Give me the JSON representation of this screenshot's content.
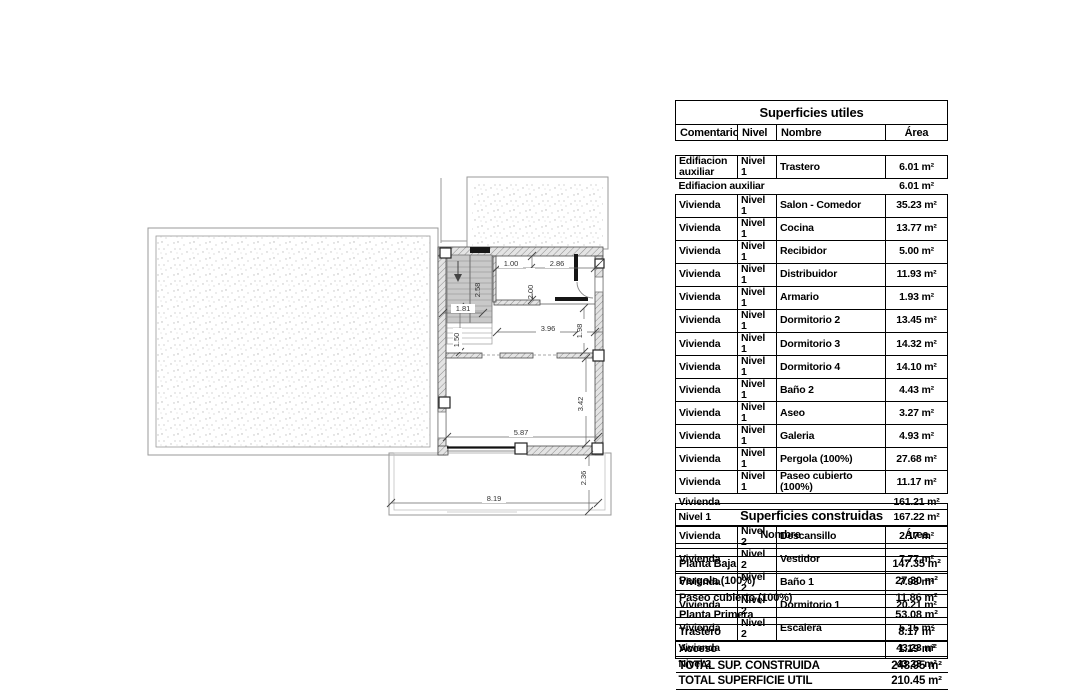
{
  "plan": {
    "dims": {
      "d100": "1.00",
      "d286": "2.86",
      "d200": "2.00",
      "d258": "2.58",
      "d181": "1.81",
      "d150": "1.50",
      "d396": "3.96",
      "d198": "1.98",
      "d342": "3.42",
      "d587": "5.87",
      "d819": "8.19",
      "d236": "2.36"
    }
  },
  "tables": {
    "utiles": {
      "title": "Superficies utiles",
      "columns": [
        "Comentarios",
        "Nivel",
        "Nombre",
        "Área"
      ],
      "rows": [
        {
          "type": "gap"
        },
        {
          "type": "data",
          "comentarios": "Edifiacion auxiliar",
          "nivel": "Nivel 1",
          "nombre": "Trastero",
          "area": "6.01 m²"
        },
        {
          "type": "summary",
          "label": "Edifiacion auxiliar",
          "area": "6.01 m²"
        },
        {
          "type": "data",
          "comentarios": "Vivienda",
          "nivel": "Nivel 1",
          "nombre": "Salon - Comedor",
          "area": "35.23 m²"
        },
        {
          "type": "data",
          "comentarios": "Vivienda",
          "nivel": "Nivel 1",
          "nombre": "Cocina",
          "area": "13.77 m²"
        },
        {
          "type": "data",
          "comentarios": "Vivienda",
          "nivel": "Nivel 1",
          "nombre": "Recibidor",
          "area": "5.00 m²"
        },
        {
          "type": "data",
          "comentarios": "Vivienda",
          "nivel": "Nivel 1",
          "nombre": "Distribuidor",
          "area": "11.93 m²"
        },
        {
          "type": "data",
          "comentarios": "Vivienda",
          "nivel": "Nivel 1",
          "nombre": "Armario",
          "area": "1.93 m²"
        },
        {
          "type": "data",
          "comentarios": "Vivienda",
          "nivel": "Nivel 1",
          "nombre": "Dormitorio 2",
          "area": "13.45 m²"
        },
        {
          "type": "data",
          "comentarios": "Vivienda",
          "nivel": "Nivel 1",
          "nombre": "Dormitorio 3",
          "area": "14.32 m²"
        },
        {
          "type": "data",
          "comentarios": "Vivienda",
          "nivel": "Nivel 1",
          "nombre": "Dormitorio 4",
          "area": "14.10 m²"
        },
        {
          "type": "data",
          "comentarios": "Vivienda",
          "nivel": "Nivel 1",
          "nombre": "Baño 2",
          "area": "4.43 m²"
        },
        {
          "type": "data",
          "comentarios": "Vivienda",
          "nivel": "Nivel 1",
          "nombre": "Aseo",
          "area": "3.27 m²"
        },
        {
          "type": "data",
          "comentarios": "Vivienda",
          "nivel": "Nivel 1",
          "nombre": "Galeria",
          "area": "4.93 m²"
        },
        {
          "type": "data",
          "comentarios": "Vivienda",
          "nivel": "Nivel 1",
          "nombre": "Pergola (100%)",
          "area": "27.68 m²"
        },
        {
          "type": "data",
          "comentarios": "Vivienda",
          "nivel": "Nivel 1",
          "nombre": "Paseo cubierto (100%)",
          "area": "11.17 m²"
        },
        {
          "type": "summary",
          "label": "Vivienda",
          "area": "161.21 m²"
        },
        {
          "type": "summary",
          "label": "Nivel 1",
          "area": "167.22 m²"
        },
        {
          "type": "data",
          "comentarios": "Vivienda",
          "nivel": "Nivel 2",
          "nombre": "Descansillo",
          "area": "2.17 m²"
        },
        {
          "type": "data",
          "comentarios": "Vivienda",
          "nivel": "Nivel 2",
          "nombre": "Vestidor",
          "area": "7.77 m²"
        },
        {
          "type": "data",
          "comentarios": "Vivienda",
          "nivel": "Nivel 2",
          "nombre": "Baño 1",
          "area": "7.93 m²"
        },
        {
          "type": "data",
          "comentarios": "Vivienda",
          "nivel": "Nivel 2",
          "nombre": "Dormitorio 1",
          "area": "20.21 m²"
        },
        {
          "type": "data",
          "comentarios": "Vivienda",
          "nivel": "Nivel 2",
          "nombre": "Escalera",
          "area": "5.15 m²"
        },
        {
          "type": "summary",
          "label": "Vivienda",
          "area": "43.23 m²"
        },
        {
          "type": "summary",
          "label": "Nivel 2",
          "area": "43.23 m²"
        },
        {
          "type": "total",
          "label": "TOTAL SUPERFICIE UTIL",
          "area": "210.45 m²"
        }
      ]
    },
    "construidas": {
      "title": "Superficies construidas",
      "columns": [
        "Nombre",
        "Área"
      ],
      "rows": [
        {
          "type": "gap"
        },
        {
          "type": "data",
          "nombre": "Planta Baja",
          "area": "147.35 m²"
        },
        {
          "type": "data",
          "nombre": "Pergola (100%)",
          "area": "27.30 m²"
        },
        {
          "type": "data",
          "nombre": "Paseo cubierto (100%)",
          "area": "11.86 m²"
        },
        {
          "type": "data",
          "nombre": "Planta Primera",
          "area": "53.08 m²"
        },
        {
          "type": "data",
          "nombre": "Trastero",
          "area": "8.17 m²"
        },
        {
          "type": "data",
          "nombre": "Acceso",
          "area": "1.19 m²"
        },
        {
          "type": "total",
          "label": "TOTAL SUP. CONSTRUIDA",
          "area": "248.95 m²"
        }
      ]
    }
  }
}
